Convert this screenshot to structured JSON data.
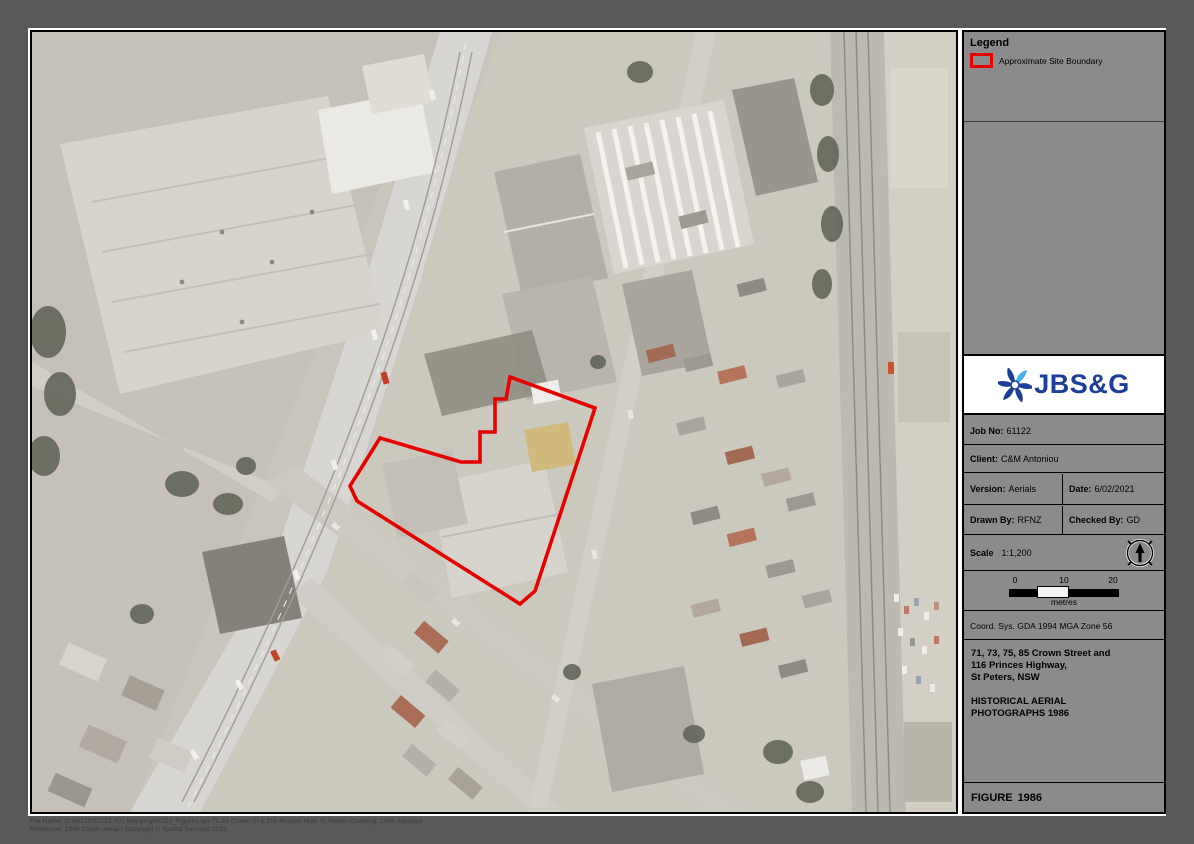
{
  "colors": {
    "site_boundary": "#e60000",
    "sidebar_gray": "#8b8b8d",
    "logo_blue": "#1d3e96",
    "frame_gray": "#59595b"
  },
  "legend": {
    "title": "Legend",
    "items": [
      {
        "symbol": "red-rectangle-outline",
        "label": "Approximate Site Boundary"
      }
    ]
  },
  "logo": {
    "text": "JBS&G"
  },
  "title_block": {
    "job_no_label": "Job No:",
    "job_no": "61122",
    "client_label": "Client:",
    "client": "C&M Antoniou",
    "version_label": "Version:",
    "version": "Aerials",
    "date_label": "Date:",
    "date": "6/02/2021",
    "drawn_by_label": "Drawn By:",
    "drawn_by": "RFNZ",
    "checked_by_label": "Checked By:",
    "checked_by": "GD",
    "scale_label": "Scale",
    "scale_value": "1:1,200",
    "coord_sys": "Coord. Sys. GDA 1994 MGA Zone 56",
    "address_line1": "71, 73, 75, 85 Crown Street and",
    "address_line2": "116 Princes Highway,",
    "address_line3": "St Peters, NSW",
    "map_title_line1": "HISTORICAL AERIAL",
    "map_title_line2": "PHOTOGRAPHS 1986",
    "figure_label": "FIGURE",
    "figure_number": "1986"
  },
  "scale_bar": {
    "tick0": "0",
    "tick1": "10",
    "tick2": "20",
    "unit": "metres"
  },
  "footer": {
    "line1": "File Name: G:\\61122\\61122-001 Mapping\\61122_Figures.apr   71-85 Crown St & 116 Princes Hwy, St Peters   Covering: 1986 Adjusted",
    "line2": "Reference: 1986 Crown aerial   |   Copyright © Spatial Services 2021"
  },
  "map": {
    "description": "Historical grayscale aerial photograph, St Peters NSW, 1986",
    "site_boundary_points": "478,345 563,376 503,559 488,572 325,469 318,454 348,406 429,430 448,430 448,400 463,400 463,367 474,367"
  }
}
